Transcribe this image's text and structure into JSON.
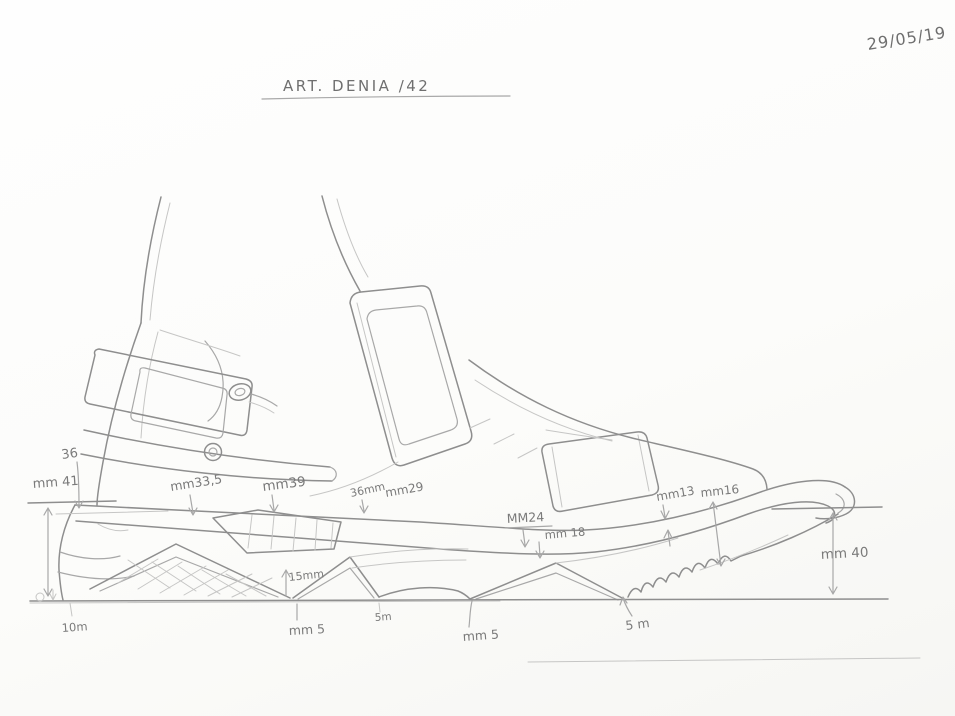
{
  "colors": {
    "paper": "#fbfbf9",
    "pencil": "#8e8e8e",
    "pencil_light": "#c6c6c5",
    "handwriting": "#7a7a7a"
  },
  "header": {
    "date": "29/05/19",
    "title": "ART. DENIA /42"
  },
  "annotations": {
    "back_height": "36",
    "heel_height": "mm 41",
    "heel_sole_height": "mm33,5",
    "arch_sole_height": "mm39",
    "midfoot_height_a": "36mm",
    "midfoot_height_b": "mm29",
    "forefoot_height_a": "MM24",
    "forefoot_height_b": "mm 18",
    "toe_height_a": "mm13",
    "toe_height_b": "mm16",
    "toe_stack_height": "mm 40",
    "arch_clearance": "15mm",
    "heel_lug": "10m",
    "lug_1": "mm 5",
    "lug_2": "5m",
    "lug_3": "mm 5",
    "lug_4": "5 m"
  }
}
